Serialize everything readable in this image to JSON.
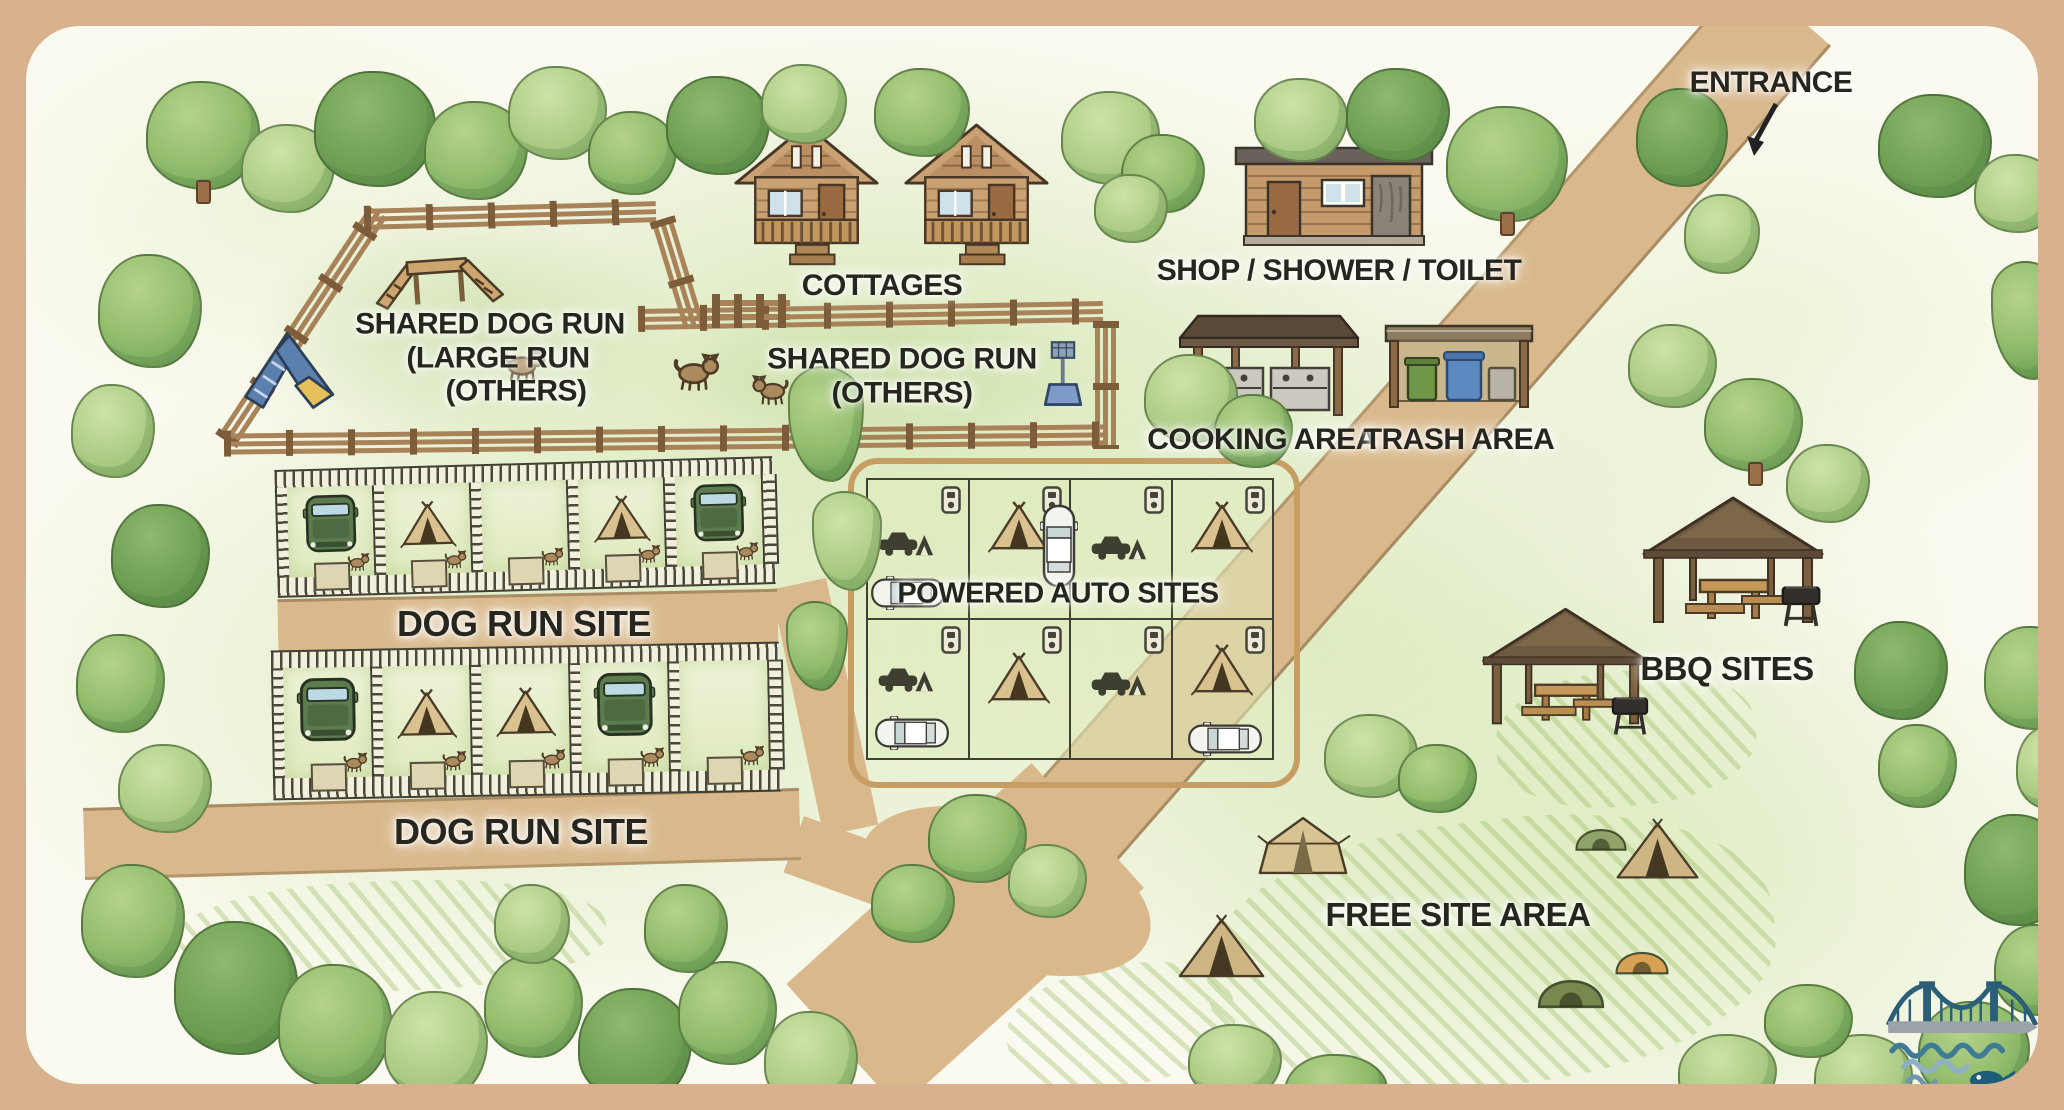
{
  "title": "Illustrated campground guide map",
  "colors": {
    "frame": "#d8b28e",
    "road": "#d9b98c",
    "grass": "#cde3a8",
    "label_ink": "#26261f",
    "logo_teal": "#2b5f78"
  },
  "labels": {
    "entrance": "ENTRANCE",
    "cottages": "COTTAGES",
    "shop_shower_toilet": "SHOP / SHOWER / TOILET",
    "cooking_area": "COOKING AREA",
    "trash_area": "TRASH AREA",
    "shared_dog_run_large": [
      "SHARED DOG RUN",
      "(LARGE RUN",
      "(OTHERS)"
    ],
    "shared_dog_run_others": [
      "SHARED DOG RUN",
      "(OTHERS)"
    ],
    "dog_run_site_upper": "DOG RUN SITE",
    "dog_run_site_lower": "DOG RUN SITE",
    "powered_auto_sites": "POWERED AUTO SITES",
    "bbq_sites": "BBQ SITES",
    "free_site_area": "FREE SITE AREA"
  }
}
